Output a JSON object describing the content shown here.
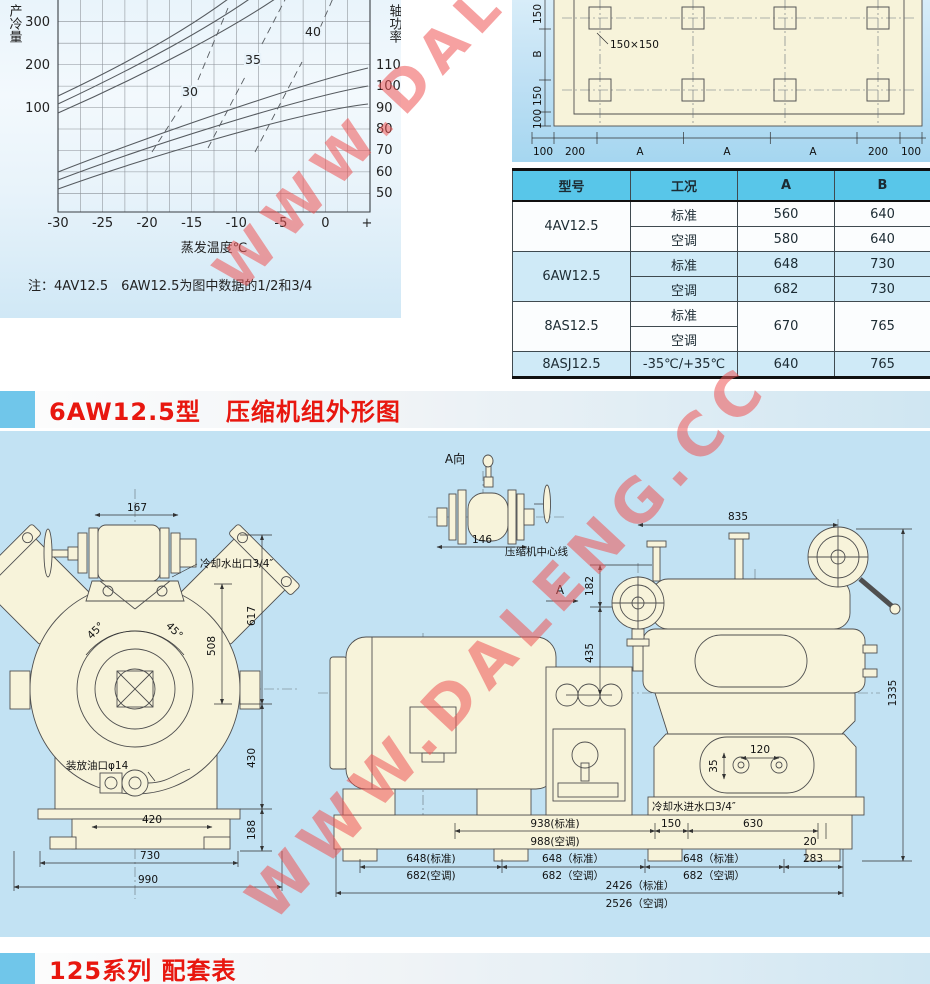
{
  "watermark": {
    "text": "WWW.DALENG.CC",
    "color": "#ef5656"
  },
  "performance_chart": {
    "left_axis_label": "产冷量",
    "right_axis_label": "轴功率",
    "x_axis_label": "蒸发温度℃",
    "left_ticks": [
      "300",
      "200",
      "100"
    ],
    "right_ticks": [
      "110",
      "100",
      "90",
      "80",
      "70",
      "60",
      "50"
    ],
    "x_ticks": [
      "-30",
      "-25",
      "-20",
      "-15",
      "-10",
      "-5",
      "0",
      "+"
    ],
    "curve_labels": [
      "30",
      "35",
      "40"
    ],
    "note": "注：4AV12.5　6AW12.5为图中数据的1/2和3/4"
  },
  "chart_data": {
    "type": "line",
    "xlabel": "蒸发温度℃",
    "ylabel_left": "产冷量",
    "ylabel_right": "轴功率",
    "x": [
      -30,
      -25,
      -20,
      -15,
      -10,
      -5,
      0
    ],
    "xlim": [
      -30,
      2
    ],
    "ylim_left": [
      50,
      350
    ],
    "ylim_right": [
      45,
      115
    ],
    "grid": true,
    "series": [
      {
        "name": "产冷量-30",
        "axis": "left",
        "values": [
          112,
          150,
          193,
          243,
          300,
          365,
          435
        ]
      },
      {
        "name": "产冷量-35",
        "axis": "left",
        "values": [
          98,
          133,
          172,
          218,
          272,
          333,
          400
        ]
      },
      {
        "name": "产冷量-40",
        "axis": "left",
        "values": [
          85,
          117,
          153,
          196,
          246,
          303,
          366
        ]
      },
      {
        "name": "轴功率-30",
        "axis": "right",
        "values": [
          57,
          66,
          75,
          85,
          95,
          104,
          110
        ]
      },
      {
        "name": "轴功率-35",
        "axis": "right",
        "values": [
          52,
          60,
          68,
          77,
          86,
          94,
          100
        ]
      },
      {
        "name": "轴功率-40",
        "axis": "right",
        "values": [
          48,
          55,
          62,
          70,
          78,
          85,
          90
        ]
      }
    ],
    "annotations": [
      "30",
      "35",
      "40"
    ],
    "note": "注：4AV12.5　6AW12.5为图中数据的1/2和3/4"
  },
  "foundation_plan": {
    "hole_size_label": "150×150",
    "left_dims": [
      "150",
      "B",
      "150",
      "100"
    ],
    "bottom_dims": [
      "100",
      "200",
      "A",
      "A",
      "A",
      "200",
      "100"
    ]
  },
  "spec_table": {
    "headers": [
      "型号",
      "工况",
      "A",
      "B"
    ],
    "groups": [
      {
        "model": "4AV12.5",
        "rows": [
          [
            "标准",
            "560",
            "640"
          ],
          [
            "空调",
            "580",
            "640"
          ]
        ]
      },
      {
        "model": "6AW12.5",
        "rows": [
          [
            "标准",
            "648",
            "730"
          ],
          [
            "空调",
            "682",
            "730"
          ]
        ]
      },
      {
        "model": "8AS12.5",
        "rows": [
          [
            "标准"
          ],
          [
            "空调"
          ]
        ],
        "a": "670",
        "b": "765"
      },
      {
        "model": "8ASJ12.5",
        "rows": [
          [
            "-35℃/+35℃",
            "640",
            "765"
          ]
        ]
      }
    ]
  },
  "sections": {
    "outline_title": "6AW12.5型　压缩机组外形图",
    "matching_title": "125系列 配套表"
  },
  "drawing": {
    "detail": {
      "view_label": "A向",
      "dim_146": "146",
      "centerline": "压缩机中心线",
      "view_arrow": "A"
    },
    "front": {
      "dim_167": "167",
      "water_outlet": "冷却水出口3/4″",
      "dim_617": "617",
      "dim_508": "508",
      "angle_l": "45°",
      "angle_r": "45°",
      "oil_port": "装放油口φ14",
      "dim_430": "430",
      "dim_188": "188",
      "dim_420": "420",
      "dim_730": "730",
      "dim_990": "990"
    },
    "side": {
      "dim_835": "835",
      "dim_182": "182",
      "dim_435": "435",
      "dim_1335": "1335",
      "dim_120": "120",
      "dim_35": "35",
      "water_inlet": "冷却水进水口3/4″",
      "dim_938": "938(标准)",
      "dim_988": "988(空调)",
      "dim_150": "150",
      "dim_630": "630",
      "dim_20": "20",
      "row2": [
        "648(标准)",
        "648（标准）",
        "648（标准）",
        "283"
      ],
      "row2b": [
        "682(空调)",
        "682（空调）",
        "682（空调）"
      ],
      "total_std": "2426（标准）",
      "total_ac": "2526（空调）"
    }
  }
}
